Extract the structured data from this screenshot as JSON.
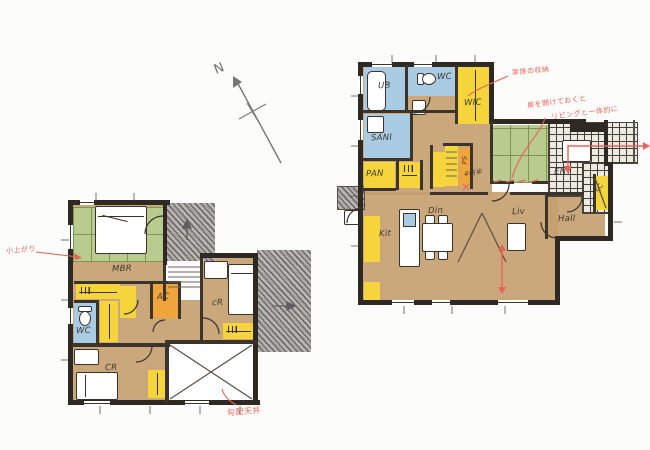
{
  "north": {
    "label": "N"
  },
  "floor1": {
    "rooms": {
      "ub": "UB",
      "wc": "WC",
      "wic": "WIC",
      "sani": "SANI",
      "pan": "PAN",
      "ps": "PS",
      "size_note": "4帖半",
      "ent": "ENT",
      "hall": "Hall",
      "sc": "SC",
      "liv": "Liv",
      "din": "Din",
      "kit": "Kit"
    }
  },
  "floor2": {
    "rooms": {
      "mbr": "MBR",
      "wc": "WC",
      "ac": "AC",
      "cr_right": "cR",
      "cr_bottom": "CR"
    }
  },
  "annotations": {
    "family_storage": "家族の収納",
    "living_note_1": "扉を開けておくと",
    "living_note_2": "リビングと一体的に",
    "koagari": "小上がり",
    "sloped_ceiling": "勾配天井"
  },
  "colors": {
    "wall": "#2e2922",
    "floor": "#c59f6e",
    "water": "#a9cce4",
    "closet": "#f5d53b",
    "tatami": "#bacb8f",
    "service": "#f0a43d",
    "annotation_red": "#e8635a",
    "pencil": "#7a7a7a"
  }
}
